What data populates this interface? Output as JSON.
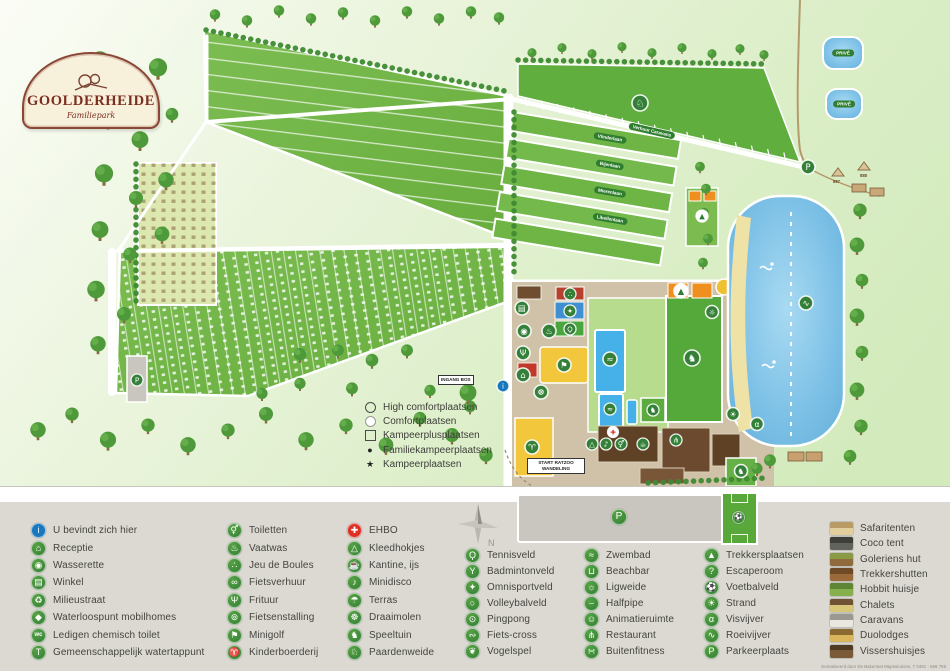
{
  "palette": {
    "icon_green": "#358038",
    "info_blue": "#1878be",
    "ehbo_red": "#dd3126",
    "lake_blue": "#7cc0e6",
    "field_green": "#6cb43f",
    "legend_bg": "#dbd9d2",
    "brand_red": "#7c2e20",
    "sand": "#efe2a6"
  },
  "logo": {
    "title": "GOOLDERHEIDE",
    "subtitle": "Familiepark"
  },
  "map": {
    "signs": {
      "ingang_bos": "INGANG BOS",
      "start_ratzoo_1": "START RATZOO",
      "start_ratzoo_2": "WANDELING",
      "prive": "PRIVÉ"
    },
    "streets": [
      "Verhuur Caravans",
      "Vlinderlaan",
      "Bijenlaan",
      "Mierenlaan",
      "Libellenlaan"
    ],
    "tent_numbers": [
      "887",
      "888"
    ],
    "pitch_legend": [
      {
        "symbol": "circle-outline",
        "char": "",
        "label": "High comfortplaatsen"
      },
      {
        "symbol": "circle-filled",
        "char": "",
        "label": "Comfortplaatsen"
      },
      {
        "symbol": "square-outline",
        "char": "",
        "label": "Kampeerplusplaatsen"
      },
      {
        "symbol": "char",
        "char": "●",
        "label": "Familiekampeerplaatsen"
      },
      {
        "symbol": "char",
        "char": "★",
        "label": "Kampeerplaatsen"
      }
    ],
    "icons": [
      {
        "name": "paardenweide-map-icon",
        "glyph": "♘",
        "x": 640,
        "y": 103,
        "r": 8
      },
      {
        "name": "winkel-map-icon",
        "glyph": "▤",
        "x": 522,
        "y": 308
      },
      {
        "name": "wasserette-map-icon",
        "glyph": "◉",
        "x": 524,
        "y": 331
      },
      {
        "name": "vaatwas-map-icon",
        "glyph": "♨",
        "x": 549,
        "y": 331
      },
      {
        "name": "frituur-map-icon",
        "glyph": "Ψ",
        "x": 523,
        "y": 353
      },
      {
        "name": "receptie-map-icon",
        "glyph": "⌂",
        "x": 523,
        "y": 375
      },
      {
        "name": "draaimolen-map-icon",
        "glyph": "☸",
        "x": 541,
        "y": 392
      },
      {
        "name": "jeu-de-boules-map-icon",
        "glyph": "∴",
        "x": 570,
        "y": 294,
        "r": 6
      },
      {
        "name": "omnisport-map-icon",
        "glyph": "✦",
        "x": 570,
        "y": 311,
        "r": 6
      },
      {
        "name": "tennis-map-icon",
        "glyph": "Ϙ",
        "x": 570,
        "y": 329,
        "r": 6
      },
      {
        "name": "minigolf-map-icon",
        "glyph": "⚑",
        "x": 564,
        "y": 365
      },
      {
        "name": "zwembad-map-icon",
        "glyph": "≈",
        "x": 610,
        "y": 359
      },
      {
        "name": "zwembad-map-icon-2",
        "glyph": "≈",
        "x": 610,
        "y": 409,
        "r": 6
      },
      {
        "name": "speeltuin-map-icon",
        "glyph": "♞",
        "x": 653,
        "y": 410,
        "r": 6
      },
      {
        "name": "speeltuin-map-icon-2",
        "glyph": "♞",
        "x": 692,
        "y": 358,
        "r": 8
      },
      {
        "name": "speeltuin-map-icon-3",
        "glyph": "♞",
        "x": 741,
        "y": 471,
        "r": 6.5
      },
      {
        "name": "trekkersplaatsen-map-icon",
        "glyph": "▲",
        "x": 681,
        "y": 291,
        "bg": "#ffffff",
        "fg": "#2e7d32"
      },
      {
        "name": "trekkersplaatsen-map-icon-2",
        "glyph": "▲",
        "x": 702,
        "y": 216,
        "bg": "#ffffff",
        "fg": "#2e7d32",
        "r": 6
      },
      {
        "name": "kleedhokjes-map-icon",
        "glyph": "△",
        "x": 592,
        "y": 444,
        "r": 6
      },
      {
        "name": "minidisco-map-icon",
        "glyph": "♪",
        "x": 606,
        "y": 444,
        "r": 6
      },
      {
        "name": "toiletten-map-icon",
        "glyph": "⚥",
        "x": 621,
        "y": 444,
        "r": 6
      },
      {
        "name": "kantine-map-icon",
        "glyph": "☕",
        "x": 643,
        "y": 444,
        "r": 6
      },
      {
        "name": "restaurant-map-icon",
        "glyph": "⋔",
        "x": 676,
        "y": 440,
        "r": 6
      },
      {
        "name": "ehbo-map-icon",
        "glyph": "✚",
        "x": 613,
        "y": 432,
        "bg": "#ffffff",
        "fg": "#dd3126",
        "r": 5.5
      },
      {
        "name": "kinderboerderij-map-icon",
        "glyph": "♈",
        "x": 532,
        "y": 447
      },
      {
        "name": "info-map-icon",
        "glyph": "i",
        "x": 503,
        "y": 386,
        "bg": "#1878be",
        "r": 6
      },
      {
        "name": "parkeer-map-icon",
        "glyph": "P",
        "x": 137,
        "y": 380,
        "r": 6
      },
      {
        "name": "parkeer-map-icon-2",
        "glyph": "P",
        "x": 808,
        "y": 167,
        "r": 7
      },
      {
        "name": "strand-map-icon",
        "glyph": "☀",
        "x": 733,
        "y": 414,
        "r": 6.5
      },
      {
        "name": "visvijver-map-icon",
        "glyph": "α",
        "x": 757,
        "y": 424,
        "r": 6.5
      },
      {
        "name": "roeivijver-map-icon",
        "glyph": "∿",
        "x": 806,
        "y": 303,
        "r": 7
      },
      {
        "name": "ligweide-map-icon",
        "glyph": "☼",
        "x": 712,
        "y": 312,
        "r": 6.5
      }
    ]
  },
  "legend": {
    "columns": [
      {
        "items": [
          {
            "icon": "info-icon",
            "glyph": "i",
            "color": "#1878be",
            "label": "U bevindt zich hier"
          },
          {
            "icon": "receptie-icon",
            "glyph": "⌂",
            "label": "Receptie"
          },
          {
            "icon": "wasserette-icon",
            "glyph": "◉",
            "label": "Wasserette"
          },
          {
            "icon": "winkel-icon",
            "glyph": "▤",
            "label": "Winkel"
          },
          {
            "icon": "milieustraat-icon",
            "glyph": "♻",
            "label": "Milieustraat"
          },
          {
            "icon": "waterloospunt-icon",
            "glyph": "◆",
            "label": "Waterloospunt mobilhomes"
          },
          {
            "icon": "chemisch-toilet-icon",
            "glyph": "wc",
            "label": "Ledigen chemisch toilet"
          },
          {
            "icon": "watertappunt-icon",
            "glyph": "T",
            "label": "Gemeenschappelijk watertappunt"
          }
        ]
      },
      {
        "items": [
          {
            "icon": "toiletten-icon",
            "glyph": "⚥",
            "label": "Toiletten"
          },
          {
            "icon": "vaatwas-icon",
            "glyph": "♨",
            "label": "Vaatwas"
          },
          {
            "icon": "jeu-de-boules-icon",
            "glyph": "∴",
            "label": "Jeu de Boules"
          },
          {
            "icon": "fietsverhuur-icon",
            "glyph": "∞",
            "label": "Fietsverhuur"
          },
          {
            "icon": "frituur-icon",
            "glyph": "Ψ",
            "label": "Frituur"
          },
          {
            "icon": "fietsenstalling-icon",
            "glyph": "⊚",
            "label": "Fietsenstalling"
          },
          {
            "icon": "minigolf-icon",
            "glyph": "⚑",
            "label": "Minigolf"
          },
          {
            "icon": "kinderboerderij-icon",
            "glyph": "♈",
            "label": "Kinderboerderij"
          }
        ]
      },
      {
        "items": [
          {
            "icon": "ehbo-icon",
            "glyph": "✚",
            "color": "#dd3126",
            "label": "EHBO"
          },
          {
            "icon": "kleedhokjes-icon",
            "glyph": "△",
            "label": "Kleedhokjes"
          },
          {
            "icon": "kantine-icon",
            "glyph": "☕",
            "label": "Kantine, ijs"
          },
          {
            "icon": "minidisco-icon",
            "glyph": "♪",
            "label": "Minidisco"
          },
          {
            "icon": "terras-icon",
            "glyph": "☂",
            "label": "Terras"
          },
          {
            "icon": "draaimolen-icon",
            "glyph": "☸",
            "label": "Draaimolen"
          },
          {
            "icon": "speeltuin-icon",
            "glyph": "♞",
            "label": "Speeltuin"
          },
          {
            "icon": "paardenweide-icon",
            "glyph": "♘",
            "label": "Paardenweide"
          }
        ]
      },
      {
        "items": [
          {
            "icon": "tennisveld-icon",
            "glyph": "Ϙ",
            "label": "Tennisveld"
          },
          {
            "icon": "badmintonveld-icon",
            "glyph": "Y",
            "label": "Badmintonveld"
          },
          {
            "icon": "omnisportveld-icon",
            "glyph": "✦",
            "label": "Omnisportveld"
          },
          {
            "icon": "volleybalveld-icon",
            "glyph": "○",
            "label": "Volleybalveld"
          },
          {
            "icon": "pingpong-icon",
            "glyph": "⊙",
            "label": "Pingpong"
          },
          {
            "icon": "fiets-cross-icon",
            "glyph": "∾",
            "label": "Fiets-cross"
          },
          {
            "icon": "vogelspel-icon",
            "glyph": "❦",
            "label": "Vogelspel"
          }
        ]
      },
      {
        "items": [
          {
            "icon": "zwembad-icon",
            "glyph": "≈",
            "label": "Zwembad"
          },
          {
            "icon": "beachbar-icon",
            "glyph": "⊔",
            "label": "Beachbar"
          },
          {
            "icon": "ligweide-icon",
            "glyph": "☼",
            "label": "Ligweide"
          },
          {
            "icon": "halfpipe-icon",
            "glyph": "⌣",
            "label": "Halfpipe"
          },
          {
            "icon": "animatieruimte-icon",
            "glyph": "☺",
            "label": "Animatieruimte"
          },
          {
            "icon": "restaurant-icon",
            "glyph": "⋔",
            "label": "Restaurant"
          },
          {
            "icon": "buitenfitness-icon",
            "glyph": "∺",
            "label": "Buitenfitness"
          }
        ]
      },
      {
        "items": [
          {
            "icon": "trekkersplaatsen-icon",
            "glyph": "▲",
            "label": "Trekkersplaatsen"
          },
          {
            "icon": "escaperoom-icon",
            "glyph": "?",
            "label": "Escaperoom"
          },
          {
            "icon": "voetbalveld-icon",
            "glyph": "⚽",
            "label": "Voetbalveld"
          },
          {
            "icon": "strand-icon",
            "glyph": "☀",
            "label": "Strand"
          },
          {
            "icon": "visvijver-icon",
            "glyph": "α",
            "label": "Visvijver"
          },
          {
            "icon": "roeivijver-icon",
            "glyph": "∿",
            "label": "Roeivijver"
          },
          {
            "icon": "parkeerplaats-icon",
            "glyph": "P",
            "label": "Parkeerplaats"
          }
        ]
      },
      {
        "type": "accommodations",
        "items": [
          {
            "icon": "safaritent-thumb",
            "base": "#e3cf9e",
            "roof": "#b99b66",
            "label": "Safaritenten"
          },
          {
            "icon": "coco-tent-thumb",
            "base": "#63635d",
            "roof": "#3f3f3a",
            "label": "Coco tent"
          },
          {
            "icon": "goleriens-hut-thumb",
            "base": "#8f6a3c",
            "roof": "#8a9a45",
            "label": "Goleriens hut"
          },
          {
            "icon": "trekkershut-thumb",
            "base": "#9a6a3a",
            "roof": "#6f4a26",
            "label": "Trekkershutten"
          },
          {
            "icon": "hobbit-huisje-thumb",
            "base": "#86b04c",
            "roof": "#5d8534",
            "label": "Hobbit huisje"
          },
          {
            "icon": "chalet-thumb",
            "base": "#d6c878",
            "roof": "#6f5334",
            "label": "Chalets"
          },
          {
            "icon": "caravan-thumb",
            "base": "#e9e7df",
            "roof": "#9a9890",
            "label": "Caravans"
          },
          {
            "icon": "duolodge-thumb",
            "base": "#d9b55e",
            "roof": "#8a6a32",
            "label": "Duolodges"
          },
          {
            "icon": "vissershuisje-thumb",
            "base": "#7a5a38",
            "roof": "#4f3a22",
            "label": "Vissershuisjes"
          }
        ]
      }
    ]
  },
  "parking_label": "P",
  "credit": "Gerealiseerd door De Bakermat Mapsolutions, T 0491 - 556 755"
}
